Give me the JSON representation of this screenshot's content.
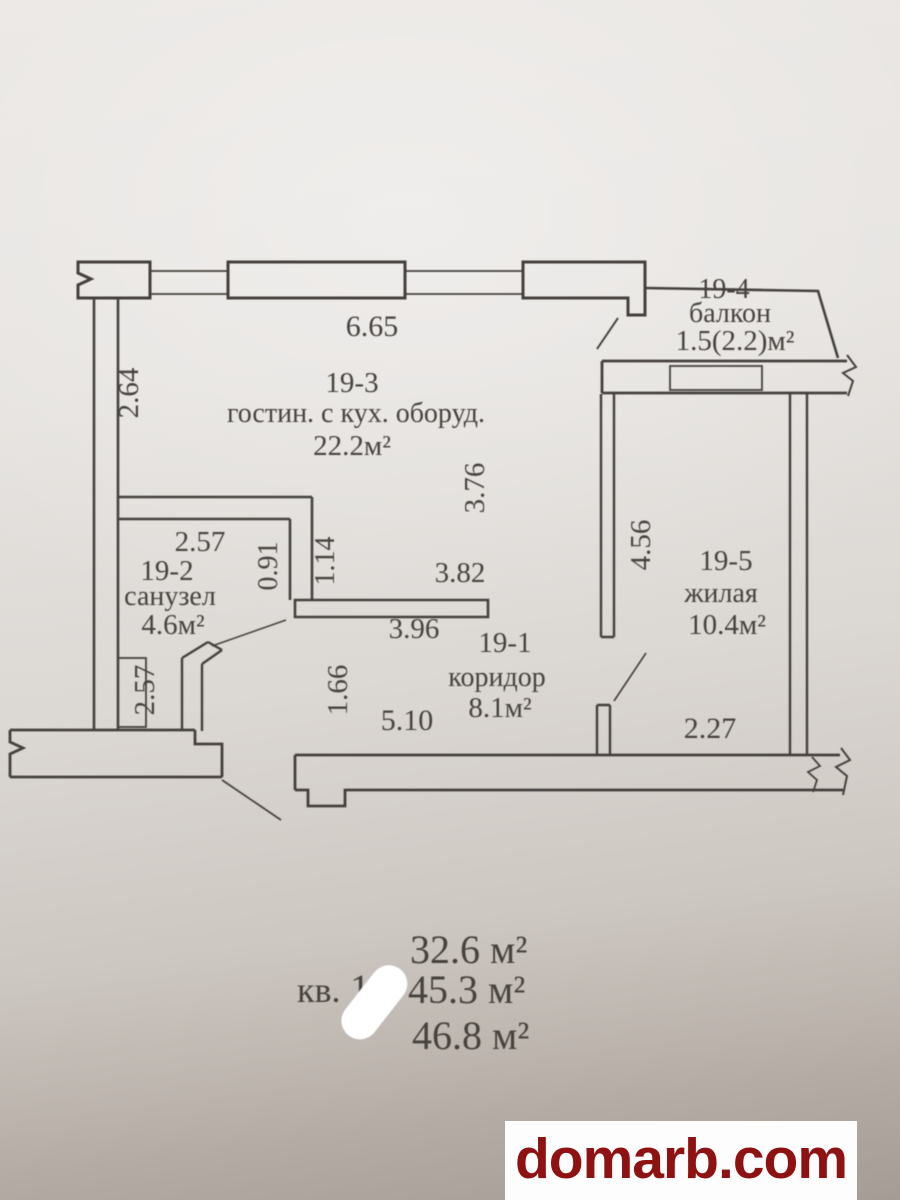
{
  "plan": {
    "rooms": {
      "living": {
        "number": "19-3",
        "name": "гостин. с кух. оборуд.",
        "area": "22.2м²"
      },
      "bathroom": {
        "number": "19-2",
        "name": "санузел",
        "area": "4.6м²"
      },
      "corridor": {
        "number": "19-1",
        "name": "коридор",
        "area": "8.1м²"
      },
      "bedroom": {
        "number": "19-5",
        "name": "жилая",
        "area": "10.4м²"
      },
      "balcony": {
        "number": "19-4",
        "name": "балкон",
        "area": "1.5(2.2)м²"
      }
    },
    "dimensions": {
      "top_width": "6.65",
      "left_height": "2.64",
      "living_depth": "3.76",
      "bath_width": "2.57",
      "bath_height": "2.57",
      "bath_jog_inner": "0.91",
      "bath_jog_outer": "1.14",
      "passage_upper": "3.82",
      "passage_lower": "3.96",
      "corridor_height": "1.66",
      "corridor_width": "5.10",
      "bedroom_depth": "4.56",
      "bedroom_width": "2.27"
    },
    "totals": {
      "living_area": "32.6 м²",
      "apartment_label": "кв.",
      "apartment_number": "19",
      "total_area": "45.3 м²",
      "total_with_balcony": "46.8 м²"
    }
  },
  "watermark": {
    "text": "domarb.com",
    "color": "#8e1212"
  }
}
